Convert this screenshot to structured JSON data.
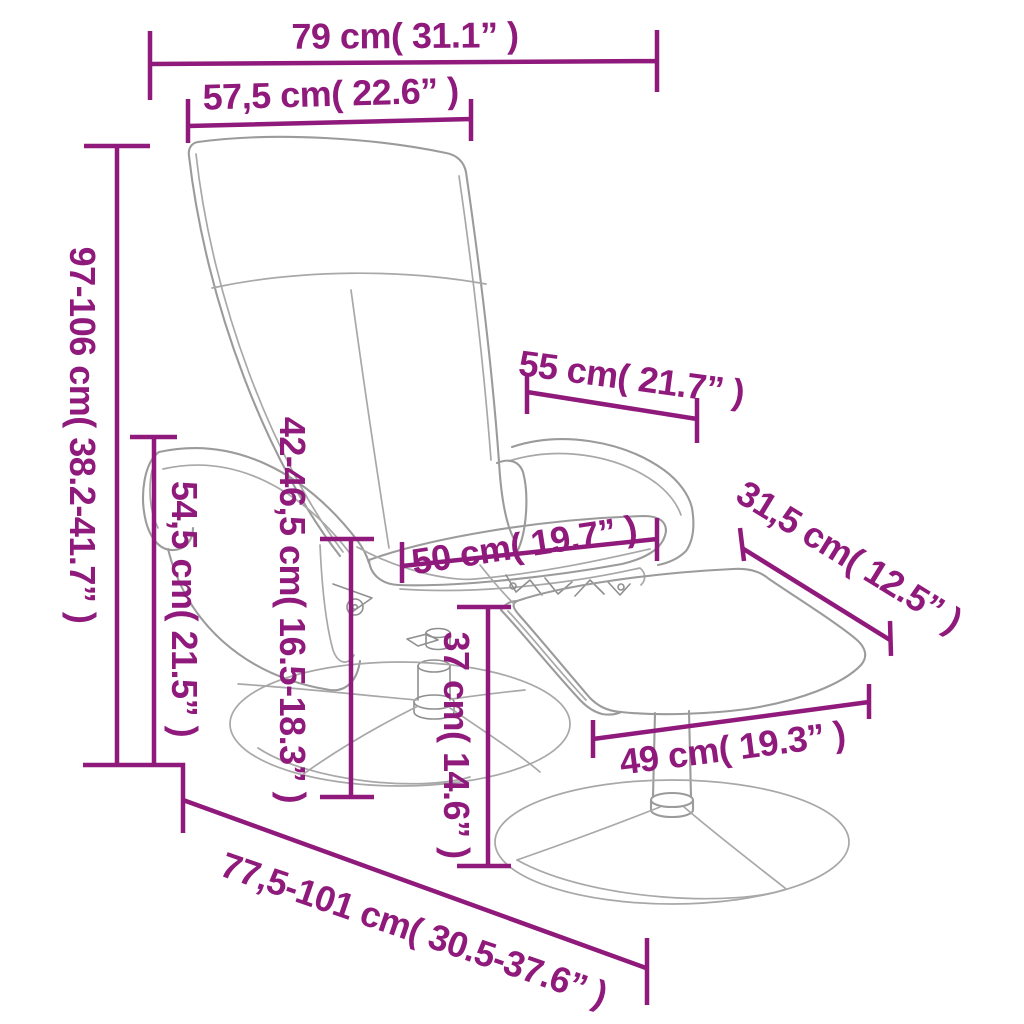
{
  "diagram": {
    "title": "Recliner chair with footstool dimension diagram",
    "accent_color": "#8F1A7C",
    "line_art_color": "#9B9B9B",
    "background": "#FFFFFF",
    "measurements": {
      "back_width": "79 cm( 31.1” )",
      "backrest_width": "57,5 cm( 22.6” )",
      "total_height": "97-106 cm( 38.2-41.7” )",
      "armrest_height": "54,5 cm( 21.5” )",
      "seat_height": "42-46,5 cm( 16.5-18.3” )",
      "backrest_inner_width": "55 cm( 21.7” )",
      "seat_width": "50 cm( 19.7” )",
      "footstool_depth": "31,5 cm( 12.5” )",
      "footstool_height": "37 cm( 14.6” )",
      "footstool_width": "49 cm( 19.3” )",
      "total_depth": "77,5-101 cm( 30.5-37.6” )"
    }
  }
}
